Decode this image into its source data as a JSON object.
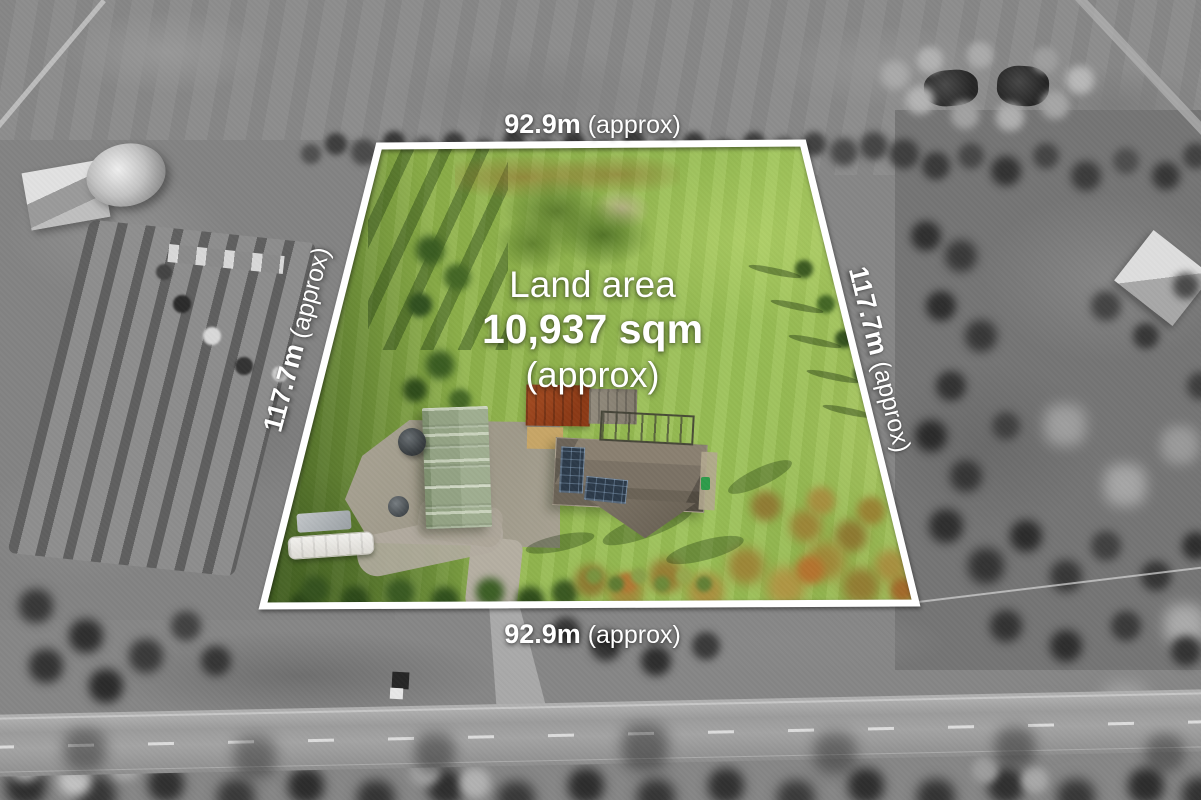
{
  "image": {
    "kind": "aerial-property-photo",
    "treatment": "surroundings desaturated to greyscale, property lot shown in colour with white boundary outline"
  },
  "overlay": {
    "land_area": {
      "title": "Land area",
      "value": "10,937 sqm",
      "qualifier": "(approx)"
    },
    "dimensions": {
      "top": {
        "value": "92.9m",
        "qualifier": "(approx)"
      },
      "bottom": {
        "value": "92.9m",
        "qualifier": "(approx)"
      },
      "left": {
        "value": "117.7m",
        "qualifier": "(approx)"
      },
      "right": {
        "value": "117.7m",
        "qualifier": "(approx)"
      }
    },
    "style": {
      "boundary_color": "#ffffff",
      "label_color": "#ffffff"
    }
  },
  "scene": {
    "inside_lot": [
      "lawn",
      "house with solar panels",
      "green shed",
      "red-roof barn",
      "pergola",
      "water tanks",
      "caravan",
      "covered trailer",
      "gravel driveway",
      "autumn trees along rear boundary"
    ],
    "outside_lot": [
      "greyscale paddocks",
      "market-garden crop rows",
      "farm shed and round tank",
      "two dams",
      "tree lines",
      "sealed road with dashed centre line",
      "truck on verge",
      "neighbouring house roof"
    ],
    "palette": {
      "lawn_green": "#8fb24a",
      "shed_green": "#93a384",
      "barn_red": "#a84f24",
      "house_roof": "#7b7265",
      "solar_panel": "#2c3a49",
      "road_grey": "#9b9b9b"
    }
  }
}
